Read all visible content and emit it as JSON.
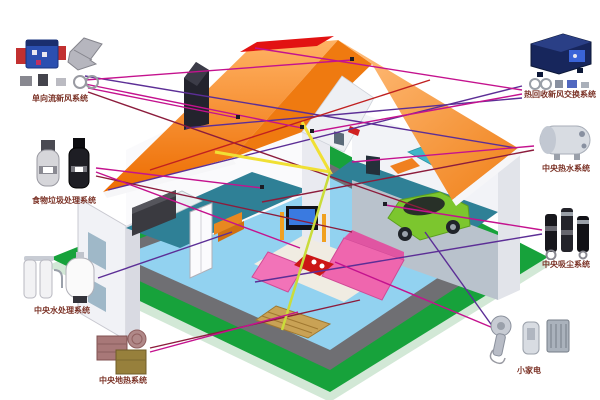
{
  "diagram": {
    "title": "home-systems-cutaway-diagram",
    "label_color": "#7b3226",
    "systems": [
      {
        "id": "fresh-air",
        "label": "单向流新风系统",
        "position": "top-left",
        "icon": "fresh-air-unit-icon"
      },
      {
        "id": "food-waste",
        "label": "食物垃圾处理系统",
        "position": "left",
        "icon": "garbage-disposal-icon"
      },
      {
        "id": "water",
        "label": "中央水处理系统",
        "position": "bottom-left",
        "icon": "water-filter-icon"
      },
      {
        "id": "floor-heat",
        "label": "中央地热系统",
        "position": "bottom-left-corner",
        "icon": "floor-heating-tiles-icon"
      },
      {
        "id": "heat-recovery",
        "label": "热回收新风交换系统",
        "position": "top-right",
        "icon": "heat-recovery-ventilator-icon"
      },
      {
        "id": "hot-water",
        "label": "中央热水系统",
        "position": "right",
        "icon": "hot-water-tank-icon"
      },
      {
        "id": "vacuum",
        "label": "中央吸尘系统",
        "position": "right-lower",
        "icon": "central-vacuum-icon"
      },
      {
        "id": "appliances",
        "label": "小家电",
        "position": "bottom-right",
        "icon": "small-appliances-icon"
      }
    ],
    "house_colors": {
      "roof": "#ee7a10",
      "roof_ridge_patch": "#e21212",
      "lawn": "#17a23b",
      "walkway": "#6f6f73",
      "ground_floor": "#92d2f0",
      "upper_floor": "#2f8096",
      "sofa": "#ef66ae",
      "car": "#7cc62e",
      "wall": "#f1f2f6"
    },
    "line_colors": {
      "magenta": "#c4128e",
      "purple": "#5c2e96",
      "maroon": "#8c1c3c",
      "red": "#c02020",
      "yellow": "#f0e034",
      "yellow_green": "#cadc3a"
    }
  }
}
